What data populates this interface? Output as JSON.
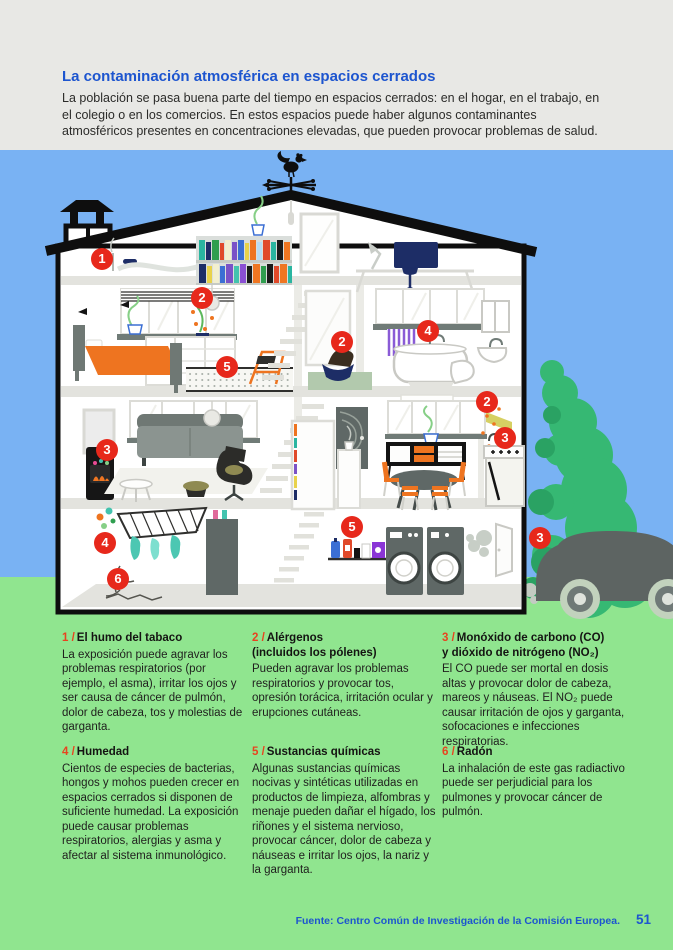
{
  "header": {
    "title": "La contaminación atmosférica en espacios cerrados",
    "intro": "La población se pasa buena parte del tiempo en espacios cerrados: en el hogar, en el trabajo, en el colegio o en los comercios. En estos espacios puede haber algunos contaminantes atmosféricos presentes en concentraciones elevadas, que pueden provocar problemas de salud."
  },
  "house": {
    "markers": [
      "1",
      "2",
      "5",
      "2",
      "4",
      "2",
      "3",
      "3",
      "5",
      "4",
      "6",
      "3"
    ]
  },
  "legend": {
    "blocks": [
      {
        "num": "1 /",
        "title": "El humo del tabaco",
        "title2": "",
        "body": "La exposición puede agravar los problemas respiratorios (por ejemplo, el asma), irritar los ojos y ser causa de cáncer de pulmón, dolor de cabeza, tos y molestias de garganta."
      },
      {
        "num": "2 /",
        "title": "Alérgenos",
        "title2": "(incluidos los pólenes)",
        "body": "Pueden agravar los problemas respiratorios y provocar tos, opresión torácica, irritación ocular y erupciones cutáneas."
      },
      {
        "num": "3 /",
        "title": "Monóxido de carbono (CO)",
        "title2": "y dióxido de nitrógeno (NO₂)",
        "body": "El CO puede ser mortal en dosis altas y provocar dolor de cabeza, mareos y náuseas. El NO₂ puede causar irritación de ojos y garganta, sofocaciones e infecciones respiratorias."
      },
      {
        "num": "4 /",
        "title": "Humedad",
        "title2": "",
        "body": "Cientos de especies de bacterias, hongos y mohos pueden crecer en espacios cerrados si disponen de suficiente humedad. La exposición puede causar problemas respiratorios, alergias y asma y afectar al sistema inmunológico."
      },
      {
        "num": "5 /",
        "title": "Sustancias químicas",
        "title2": "",
        "body": "Algunas sustancias químicas nocivas y sintéticas utilizadas en productos de limpieza, alfombras y menaje pueden dañar el hígado, los riñones y el sistema nervioso, provocar cáncer, dolor de cabeza y náuseas e irritar los ojos, la nariz y la garganta."
      },
      {
        "num": "6 /",
        "title": "Radón",
        "title2": "",
        "body": "La inhalación de este gas radiactivo puede ser perjudicial para los pulmones y provocar cáncer de pulmón."
      }
    ]
  },
  "footer": {
    "source_prefix": "Fuente: ",
    "source": "Centro Común de Investigación de la Comisión Europea.",
    "page_number": "51"
  },
  "colors": {
    "accent_blue": "#1d55cf",
    "marker_red": "#e7281b",
    "legend_number_red": "#e8431f",
    "sky": "#79b2f3",
    "grass": "#90e58f",
    "header_bg": "#e8e8e5"
  }
}
